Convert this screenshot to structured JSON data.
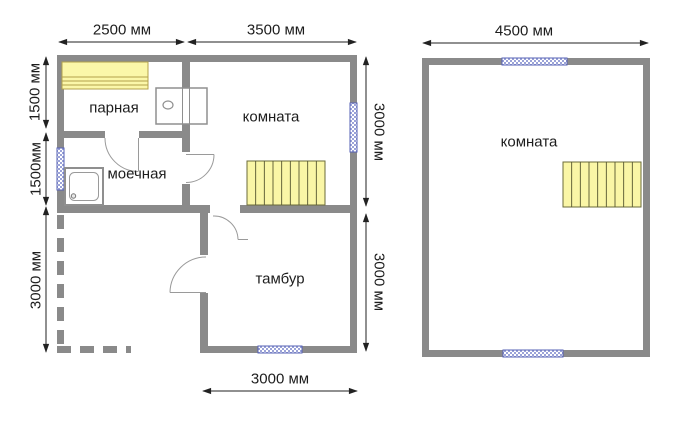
{
  "first_floor": {
    "rooms": {
      "parnaya": "парная",
      "moechnaya": "моечная",
      "komnata": "комната",
      "tambur": "тамбур"
    },
    "dims": {
      "top_parnaya_width": "2500 мм",
      "top_komnata_width": "3500 мм",
      "left_parnaya_depth": "1500 мм",
      "left_moechnaya_depth": "1500мм",
      "left_porch_depth": "3000 мм",
      "right_komnata_depth": "3000 мм",
      "right_tambur_depth": "3000 мм",
      "bottom_tambur_width": "3000 мм"
    }
  },
  "second_floor": {
    "rooms": {
      "komnata": "комната"
    },
    "dims": {
      "top_width": "4500 мм"
    }
  },
  "colors": {
    "wall_gray": "#8a8a8a",
    "furniture_yellow": "#fbf7a9",
    "window_blue": "#9ba3d8",
    "window_border_blue": "#5560b5",
    "text": "#1d1d1d"
  }
}
